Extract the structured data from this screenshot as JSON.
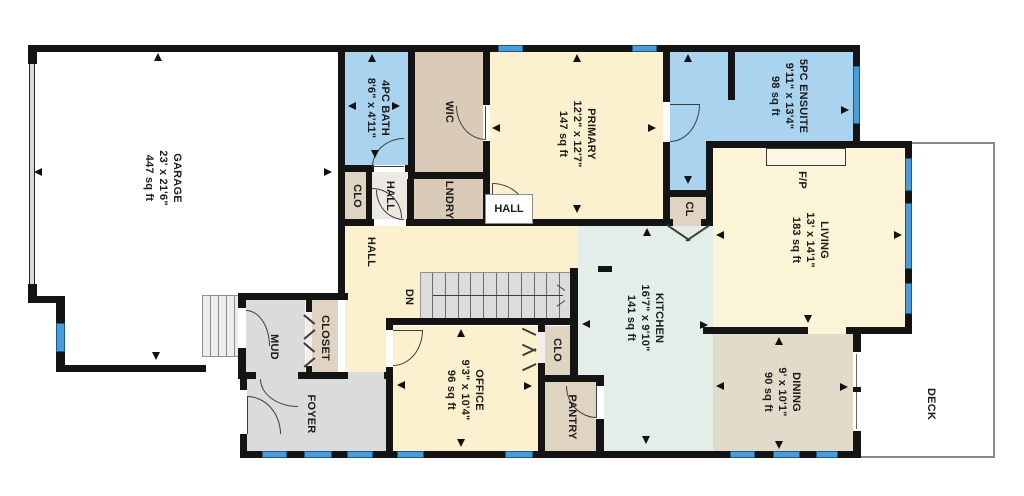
{
  "rooms": {
    "garage": {
      "name": "GARAGE",
      "dims": "23' x 21'6\"",
      "area": "447 sq ft"
    },
    "bath_4pc": {
      "name": "4PC BATH",
      "dims": "8'6\" x 4'11\""
    },
    "wic": {
      "name": "WIC"
    },
    "laundry": {
      "name": "LNDRY"
    },
    "clo_bath": {
      "name": "CLO"
    },
    "hall_small": {
      "name": "HALL"
    },
    "hall_main": {
      "name": "HALL"
    },
    "hall_primary_door": {
      "name": "HALL"
    },
    "primary": {
      "name": "PRIMARY",
      "dims": "12'2\" x 12'7\"",
      "area": "147 sq ft"
    },
    "ensuite": {
      "name": "5PC ENSUITE",
      "dims": "9'11\" x 13'4\"",
      "area": "98 sq ft"
    },
    "closet_primary": {
      "name": "CL"
    },
    "living": {
      "name": "LIVING",
      "dims": "13' x 14'1\"",
      "area": "183 sq ft"
    },
    "fireplace": {
      "name": "F/P"
    },
    "kitchen": {
      "name": "KITCHEN",
      "dims": "16'7\" x 9'10\"",
      "area": "141 sq ft"
    },
    "dining": {
      "name": "DINING",
      "dims": "9' x 10'1\"",
      "area": "90 sq ft"
    },
    "office": {
      "name": "OFFICE",
      "dims": "9'3\" x 10'4\"",
      "area": "96 sq ft"
    },
    "clo_office": {
      "name": "CLO"
    },
    "pantry": {
      "name": "PANTRY"
    },
    "mud": {
      "name": "MUD"
    },
    "closet_mud": {
      "name": "CLOSET"
    },
    "foyer": {
      "name": "FOYER"
    },
    "deck": {
      "name": "DECK"
    }
  },
  "stairs": {
    "down_label": "DN"
  },
  "colors": {
    "wall": "#141414",
    "window_blue": "#4a9cd8",
    "bath_blue": "#a9d3ee",
    "cream": "#fcf1cf",
    "tan": "#d9cbb8",
    "closet_tan": "#dfd3c2",
    "kitchen_mint": "#e3eee8",
    "dining_tan": "#e3dbc9",
    "gray": "#dbdbdb",
    "deck_outline": "#8a8a8a"
  }
}
